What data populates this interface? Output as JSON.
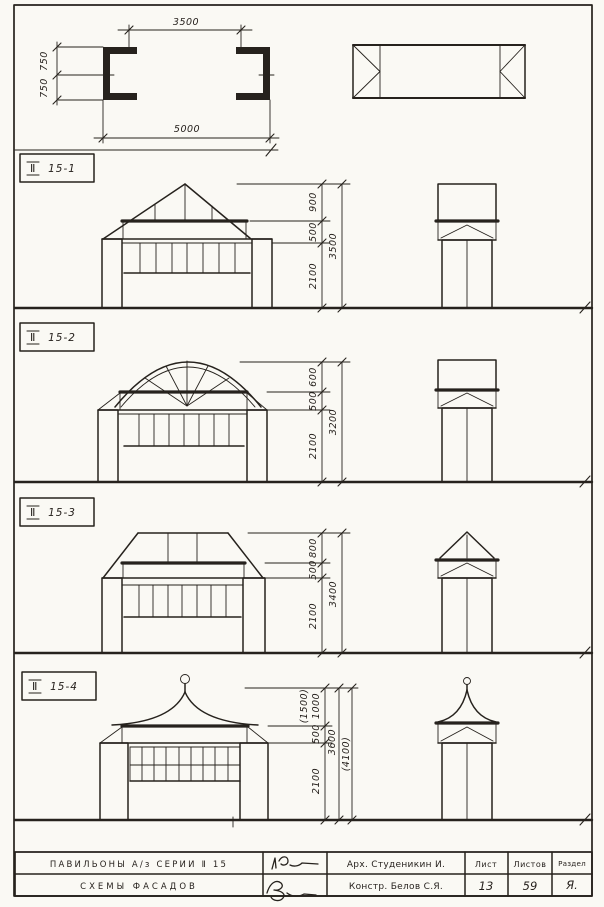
{
  "sheet": {
    "background": "#faf9f4",
    "ink": "#26221d"
  },
  "plan": {
    "top_width": "3500",
    "bottom_width": "5000",
    "left_upper": "750",
    "left_lower": "750"
  },
  "sections": [
    {
      "label_prefix": "Ⅱ",
      "label_code": "15-1",
      "dim_roof": "900",
      "dim_frieze": "500",
      "dim_opening": "2100",
      "dim_total": "3500"
    },
    {
      "label_prefix": "Ⅱ",
      "label_code": "15-2",
      "dim_roof": "600",
      "dim_frieze": "500",
      "dim_opening": "2100",
      "dim_total": "3200"
    },
    {
      "label_prefix": "Ⅱ",
      "label_code": "15-3",
      "dim_roof": "800",
      "dim_frieze": "500",
      "dim_opening": "2100",
      "dim_total": "3400"
    },
    {
      "label_prefix": "Ⅱ",
      "label_code": "15-4",
      "dim_roof_alt": "(1500)",
      "dim_roof": "1000",
      "dim_frieze": "500",
      "dim_opening": "2100",
      "dim_total": "3600",
      "dim_total_alt": "(4100)"
    }
  ],
  "title_block": {
    "project_title": "ПАВИЛЬОНЫ  А/з  СЕРИИ  Ⅱ 15",
    "drawing_title": "СХЕМЫ  ФАСАДОВ",
    "architect": "Арх. Студеникин И.",
    "engineer": "Констр. Белов С.Я.",
    "sheet_label": "Лист",
    "sheet_number": "13",
    "sheets_label": "Листов",
    "razdel_label": "Раздел",
    "sheets_total": "59",
    "razdel_value": "Я."
  }
}
